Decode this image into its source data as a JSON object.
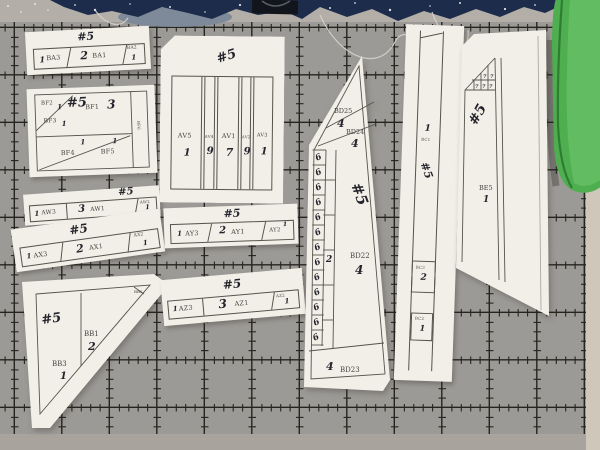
{
  "colors": {
    "mat": "#9c9a96",
    "mat_line": "#26241e",
    "mat_margin": "#b3afa8",
    "mat_edge_right": "#cfc8ba",
    "paper": "#f2efe8",
    "printed_ink": "#45453f",
    "handwritten_ink": "#24242c",
    "fabric_navy": "#1d2c4a",
    "fabric_green": "#4fae4f",
    "binder_clip": "#12151b"
  },
  "pieces": {
    "ba": {
      "hand": "#5",
      "cells": [
        {
          "num": "1",
          "label": "BA3"
        },
        {
          "num": "2",
          "label": "BA1"
        },
        {
          "num": "1",
          "label": "BA2"
        }
      ]
    },
    "bf": {
      "hand": "#5",
      "bf2": {
        "num": "1",
        "label": "BF2"
      },
      "bf3": {
        "num": "1",
        "label": "BF3"
      },
      "bf1": {
        "num": "3",
        "label": "BF1"
      },
      "bf4": {
        "num": "1",
        "label": "BF4"
      },
      "bf5": {
        "num": "1",
        "label": "BF5"
      },
      "bf6": {
        "label": "BF6"
      }
    },
    "aw": {
      "hand": "#5",
      "cells": [
        {
          "num": "1",
          "label": "AW3"
        },
        {
          "num": "3",
          "label": "AW1"
        },
        {
          "num": "1",
          "label": "AW2"
        }
      ]
    },
    "ax": {
      "hand": "#5",
      "cells": [
        {
          "num": "1",
          "label": "AX3"
        },
        {
          "num": "2",
          "label": "AX1"
        },
        {
          "num": "1",
          "label": "AX2"
        }
      ]
    },
    "bb": {
      "hand": "#5",
      "bb1": {
        "num": "2",
        "label": "BB1"
      },
      "bb3": {
        "num": "1",
        "label": "BB3"
      },
      "bb2": {
        "label": "BB2"
      }
    },
    "av": {
      "hand": "#5",
      "cols": [
        {
          "label": "AV5",
          "num": "1"
        },
        {
          "label": "AV4",
          "num": "9"
        },
        {
          "label": "AV1",
          "num": "7"
        },
        {
          "label": "AV2",
          "num": "9"
        },
        {
          "label": "AV3",
          "num": "1"
        }
      ]
    },
    "ay": {
      "hand": "#5",
      "cells": [
        {
          "num": "1",
          "label": "AY3"
        },
        {
          "num": "2",
          "label": "AY1"
        },
        {
          "num": "1",
          "label": "AY2"
        }
      ]
    },
    "az": {
      "hand": "#5",
      "cells": [
        {
          "num": "1",
          "label": "AZ3"
        },
        {
          "num": "3",
          "label": "AZ1"
        },
        {
          "num": "1",
          "label": "AZ2"
        }
      ]
    },
    "bd": {
      "hand": "#5",
      "bd25": {
        "label": "BD25",
        "num": "4"
      },
      "bd24": {
        "label": "BD24",
        "num": "4"
      },
      "bd22": {
        "label": "BD22",
        "num": "4"
      },
      "bd23": {
        "label": "BD23",
        "num": "4"
      },
      "ruler_digit": "6",
      "col2_num": "2"
    },
    "bc": {
      "hand": "#5",
      "seg1": {
        "num": "1",
        "label": "BC1"
      },
      "seg2": {
        "num": "2",
        "label": "BC3"
      },
      "seg3": {
        "num": "1",
        "label": "BC2"
      }
    },
    "be": {
      "hand": "#5",
      "label": "BE5",
      "num": "1",
      "corner_digit": "7"
    }
  }
}
